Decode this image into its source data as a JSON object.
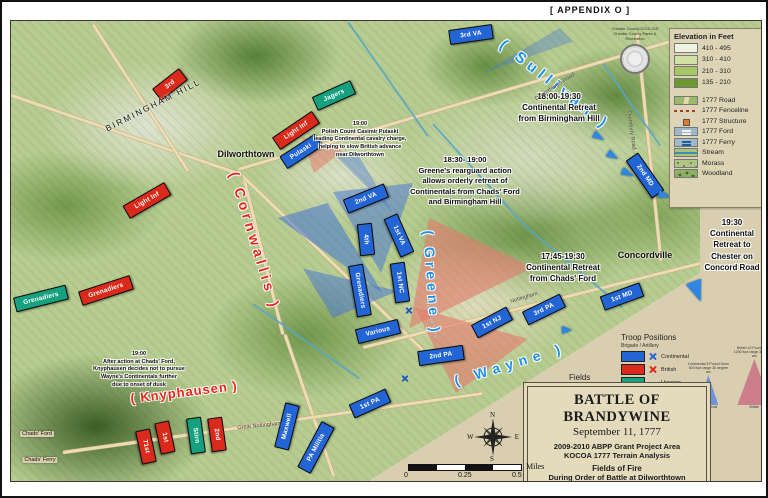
{
  "frame": {
    "appendix": "[ APPENDIX O ]"
  },
  "colors": {
    "continental": "#2465d6",
    "british": "#d92a1b",
    "hessian": "#15a17f",
    "commander_blue": "#1f8fe8",
    "commander_red": "#ea2517",
    "arrow": "#2f86e0",
    "fire_continental": "rgba(66,114,214,0.55)",
    "fire_british": "rgba(226,123,110,0.62)"
  },
  "legend": {
    "title": "Elevation in Feet",
    "seal_line1": "Chester County DCIS-GIS",
    "seal_line2": "Chester County Parks & Recreation",
    "elevation": [
      {
        "range": "410 - 495",
        "color": "#eef3e1"
      },
      {
        "range": "310 - 410",
        "color": "#cfe2a3"
      },
      {
        "range": "210 - 310",
        "color": "#a6c763"
      },
      {
        "range": "135 - 210",
        "color": "#6c9833"
      }
    ],
    "symbols": [
      {
        "label": "1777 Road",
        "type": "road"
      },
      {
        "label": "1777 Fenceline",
        "type": "fence"
      },
      {
        "label": "1777 Structure",
        "type": "structure"
      },
      {
        "label": "1777 Ford",
        "type": "ford"
      },
      {
        "label": "1777 Ferry",
        "type": "ferry"
      },
      {
        "label": "Stream",
        "type": "stream"
      },
      {
        "label": "Morass",
        "type": "morass"
      },
      {
        "label": "Woodland",
        "type": "woodland"
      }
    ]
  },
  "troop_legend": {
    "title": "Troop Positions",
    "subtitle": "Brigade / Artillery",
    "rows": [
      {
        "label": "Continental",
        "color": "#2465d6",
        "artillery": true
      },
      {
        "label": "British",
        "color": "#d92a1b",
        "artillery": true
      },
      {
        "label": "Hessian",
        "color": "#15a17f",
        "artillery": false
      }
    ]
  },
  "fire_legend": {
    "title_l1": "Fields",
    "title_l2": "of",
    "title_l3": "Fire",
    "small_items": [
      {
        "label": "Continental",
        "caption": "Brigade Regiment Cavalry 300 foot range 30 degree arc",
        "color": "#6f93dd",
        "w": 13,
        "h": 10
      },
      {
        "label": "British",
        "caption": "Brigade Regiment Cavalry 300 foot range 30 degree arc",
        "color": "#cc7f8a",
        "w": 13,
        "h": 10
      }
    ],
    "medium": {
      "label": "Continental",
      "caption": "Continental 3 Pound Guns 600 foot range 30 degree arc",
      "color": "#6f93dd",
      "w": 20,
      "h": 30
    },
    "large": {
      "label": "British",
      "caption": "British 12 Pound Guns 1200 foot range 30 degree arc",
      "color": "#cc7f8a",
      "w": 34,
      "h": 46
    }
  },
  "title_block": {
    "l1": "BATTLE OF BRANDYWINE",
    "l2": "September 11, 1777",
    "l3": "2009-2010 ABPP Grant Project Area",
    "l4": "KOCOA 1777 Terrain Analysis",
    "l5": "Fields of Fire",
    "l6": "During Order of Battle at Dilworthtown",
    "l7": "19:00, September 11, 1777"
  },
  "compass": {
    "n": "N",
    "e": "E",
    "s": "S",
    "w": "W"
  },
  "scalebar": {
    "labels": [
      "0",
      "0.25",
      "0.5"
    ],
    "unit": "Miles"
  },
  "commanders": [
    {
      "label": "( Sullivan )",
      "color": "blue",
      "x": 552,
      "y": 82,
      "rot": 38,
      "fs": 15,
      "ls": 5
    },
    {
      "label": "( Cornwallis )",
      "color": "red",
      "x": 252,
      "y": 238,
      "rot": 73,
      "fs": 14,
      "ls": 4
    },
    {
      "label": "( Greene )",
      "color": "blue",
      "x": 429,
      "y": 280,
      "rot": 86,
      "fs": 14,
      "ls": 4
    },
    {
      "label": "( Wayne )",
      "color": "blue",
      "x": 507,
      "y": 361,
      "rot": -17,
      "fs": 14,
      "ls": 6
    },
    {
      "label": "( Knyphausen )",
      "color": "red",
      "x": 181,
      "y": 389,
      "rot": -7,
      "fs": 13,
      "ls": 1
    }
  ],
  "annotations": [
    {
      "lines": [
        "18:00-19:30",
        "Continental Retreat",
        "from Birmingham Hill"
      ],
      "x": 556,
      "y": 88,
      "w": 140,
      "fs": 8
    },
    {
      "lines": [
        "18:30- 19:00",
        "Greene's rearguard action",
        "allows orderly retreat of",
        "Continentals from Chads' Ford",
        "and Birmingham Hill"
      ],
      "x": 462,
      "y": 152,
      "w": 150,
      "fs": 7.5
    },
    {
      "lines": [
        "19:00",
        "Polish Count Casimir Pulaski",
        "leading Continental cavalry charge,",
        "helping to slow British advance",
        "near Dilworthtown"
      ],
      "x": 357,
      "y": 118,
      "w": 120,
      "fs": 5.5
    },
    {
      "lines": [
        "17:45-19:30",
        "Continental Retreat",
        "from Chads' Ford"
      ],
      "x": 560,
      "y": 248,
      "w": 120,
      "fs": 8
    },
    {
      "lines": [
        "19:30",
        "Continental",
        "Retreat to",
        "Chester on",
        "Concord Road"
      ],
      "x": 729,
      "y": 214,
      "w": 72,
      "fs": 8
    },
    {
      "lines": [
        "19:00",
        "After action at Chads' Ford,",
        "Knyphausen decides not to pursue",
        "Wayne's Continentals further",
        "due to onset of dusk"
      ],
      "x": 136,
      "y": 348,
      "w": 132,
      "fs": 5.5
    }
  ],
  "places": [
    {
      "label": "Dilworthtown",
      "x": 243,
      "y": 151,
      "fs": 9,
      "rot": 0,
      "bold": true,
      "ls": 0,
      "chip": false
    },
    {
      "label": "Concordville",
      "x": 642,
      "y": 252,
      "fs": 9,
      "rot": 0,
      "bold": true,
      "ls": 0,
      "chip": false
    },
    {
      "label": "BIRMINGHAM  HILL",
      "x": 150,
      "y": 102,
      "fs": 8.5,
      "rot": -27,
      "bold": false,
      "ls": 2,
      "chip": false
    },
    {
      "label": "Chads' Ford",
      "x": 34,
      "y": 431,
      "fs": 5.5,
      "rot": 0,
      "bold": false,
      "ls": 0,
      "chip": true
    },
    {
      "label": "Chads' Ferry",
      "x": 37,
      "y": 457,
      "fs": 5.5,
      "rot": 0,
      "bold": false,
      "ls": 0,
      "chip": true
    }
  ],
  "road_labels": [
    {
      "label": "Dilworthtown Road",
      "x": 552,
      "y": 84,
      "rot": -33
    },
    {
      "label": "Nottingham",
      "x": 521,
      "y": 295,
      "rot": -17
    },
    {
      "label": "Great Nottingham",
      "x": 256,
      "y": 423,
      "rot": -6
    },
    {
      "label": "Thornbury Road",
      "x": 628,
      "y": 127,
      "rot": 82
    }
  ],
  "units": [
    {
      "label": "3rd VA",
      "f": "continental",
      "x": 467,
      "y": 30,
      "w": 42,
      "rot": -8
    },
    {
      "label": "Pulaski",
      "f": "continental",
      "x": 297,
      "y": 147,
      "w": 40,
      "rot": -33
    },
    {
      "label": "2nd VA",
      "f": "continental",
      "x": 362,
      "y": 194,
      "w": 42,
      "rot": -22
    },
    {
      "label": "1st VA",
      "f": "continental",
      "x": 395,
      "y": 231,
      "w": 40,
      "rot": 66
    },
    {
      "label": "4th",
      "f": "continental",
      "x": 362,
      "y": 235,
      "w": 30,
      "rot": 84
    },
    {
      "label": "1st NC",
      "f": "continental",
      "x": 396,
      "y": 278,
      "w": 38,
      "rot": 82
    },
    {
      "label": "Grenadiers",
      "f": "continental",
      "x": 356,
      "y": 286,
      "w": 50,
      "rot": 80
    },
    {
      "label": "Various",
      "f": "continental",
      "x": 374,
      "y": 327,
      "w": 42,
      "rot": -14
    },
    {
      "label": "1st NJ",
      "f": "continental",
      "x": 488,
      "y": 318,
      "w": 38,
      "rot": -28
    },
    {
      "label": "2nd PA",
      "f": "continental",
      "x": 437,
      "y": 351,
      "w": 44,
      "rot": -8
    },
    {
      "label": "3rd PA",
      "f": "continental",
      "x": 540,
      "y": 305,
      "w": 40,
      "rot": -26
    },
    {
      "label": "1st PA",
      "f": "continental",
      "x": 366,
      "y": 399,
      "w": 38,
      "rot": -24
    },
    {
      "label": "Maxwell",
      "f": "continental",
      "x": 283,
      "y": 422,
      "w": 44,
      "rot": -76
    },
    {
      "label": "PA Militia",
      "f": "continental",
      "x": 312,
      "y": 443,
      "w": 50,
      "rot": -62
    },
    {
      "label": "1st MD",
      "f": "continental",
      "x": 618,
      "y": 292,
      "w": 40,
      "rot": -20
    },
    {
      "label": "2nd MD",
      "f": "continental",
      "x": 641,
      "y": 171,
      "w": 44,
      "rot": 55
    },
    {
      "label": "3rd",
      "f": "british",
      "x": 166,
      "y": 80,
      "w": 32,
      "rot": -38
    },
    {
      "label": "Light Inf",
      "f": "british",
      "x": 292,
      "y": 126,
      "w": 46,
      "rot": -34
    },
    {
      "label": "Light Inf",
      "f": "british",
      "x": 143,
      "y": 196,
      "w": 46,
      "rot": -30
    },
    {
      "label": "Grenadiers",
      "f": "british",
      "x": 102,
      "y": 286,
      "w": 52,
      "rot": -18
    },
    {
      "label": "71st",
      "f": "british",
      "x": 142,
      "y": 442,
      "w": 32,
      "rot": 78
    },
    {
      "label": "1st",
      "f": "british",
      "x": 161,
      "y": 433,
      "w": 30,
      "rot": 78
    },
    {
      "label": "2nd",
      "f": "british",
      "x": 213,
      "y": 430,
      "w": 32,
      "rot": 82
    },
    {
      "label": "Jagers",
      "f": "hessian",
      "x": 330,
      "y": 91,
      "w": 40,
      "rot": -24
    },
    {
      "label": "Stirn",
      "f": "hessian",
      "x": 192,
      "y": 431,
      "w": 34,
      "rot": 82
    },
    {
      "label": "Grenadiers",
      "f": "hessian",
      "x": 37,
      "y": 294,
      "w": 52,
      "rot": -14
    }
  ],
  "arrows": [
    {
      "x": 592,
      "y": 128,
      "rot": 120,
      "s": 10
    },
    {
      "x": 606,
      "y": 147,
      "rot": 120,
      "s": 10
    },
    {
      "x": 621,
      "y": 164,
      "rot": 115,
      "s": 11
    },
    {
      "x": 658,
      "y": 186,
      "rot": 105,
      "s": 11
    },
    {
      "x": 560,
      "y": 322,
      "rot": 90,
      "s": 9
    },
    {
      "x": 686,
      "y": 278,
      "rot": 160,
      "s": 18
    }
  ],
  "artillery": {
    "positions": [
      {
        "x": 401,
        "y": 303
      },
      {
        "x": 397,
        "y": 371
      }
    ],
    "label": "3 Pound Gun Battery",
    "label_x": 410,
    "label_y": 314,
    "label_rot": 75
  }
}
